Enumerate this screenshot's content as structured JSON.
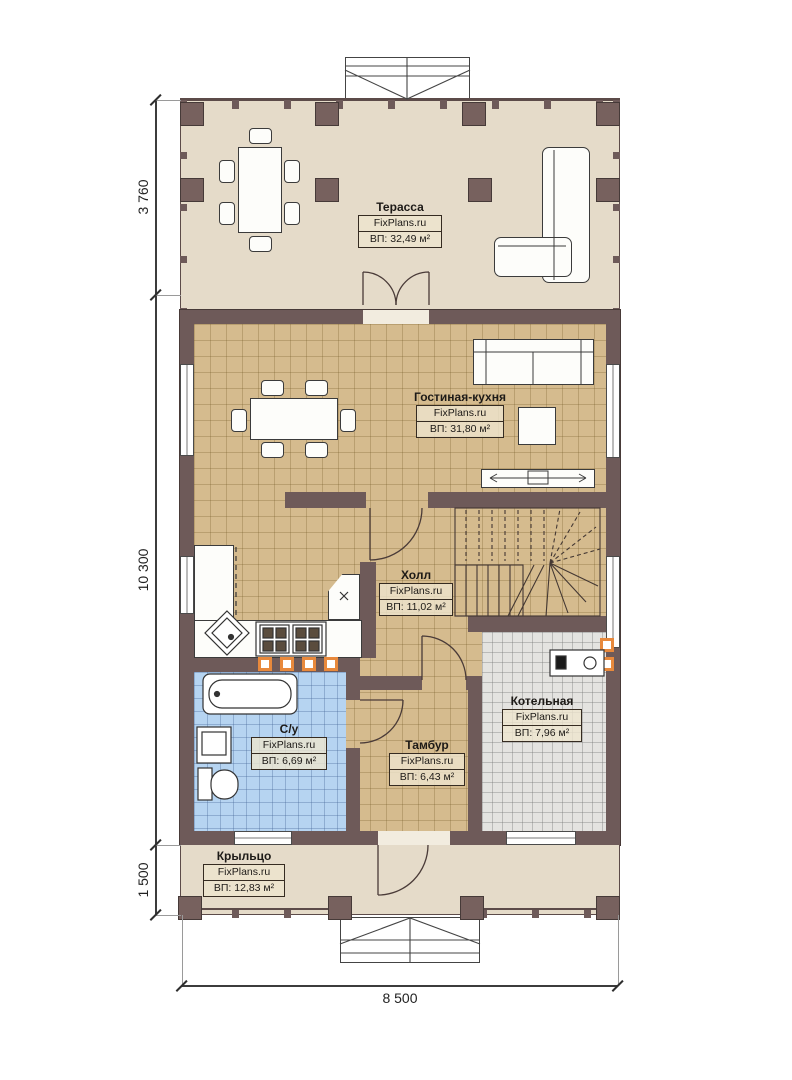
{
  "rooms": [
    {
      "id": "terrace",
      "name": "Терасса",
      "brand": "FixPlans.ru",
      "area": "ВП: 32,49 м²"
    },
    {
      "id": "living",
      "name": "Гостиная-кухня",
      "brand": "FixPlans.ru",
      "area": "ВП: 31,80 м²"
    },
    {
      "id": "hall",
      "name": "Холл",
      "brand": "FixPlans.ru",
      "area": "ВП: 11,02 м²"
    },
    {
      "id": "bathroom",
      "name": "С/у",
      "brand": "FixPlans.ru",
      "area": "ВП: 6,69 м²"
    },
    {
      "id": "vestibule",
      "name": "Тамбур",
      "brand": "FixPlans.ru",
      "area": "ВП: 6,43 м²"
    },
    {
      "id": "boiler",
      "name": "Котельная",
      "brand": "FixPlans.ru",
      "area": "ВП: 7,96 м²"
    },
    {
      "id": "porch",
      "name": "Крыльцо",
      "brand": "FixPlans.ru",
      "area": "ВП: 12,83 м²"
    }
  ],
  "dimensions": {
    "left_top": "3 760",
    "left_middle": "10 300",
    "left_bottom": "1 500",
    "bottom": "8 500"
  },
  "colors": {
    "wall": "#6e5a59",
    "terrace_floor": "#e5dbc9",
    "tile_tan": "#d5bb8e",
    "tile_blue": "#b6d4f1",
    "tile_gray": "#e4e3e0",
    "accent_orange": "#e8893c"
  }
}
